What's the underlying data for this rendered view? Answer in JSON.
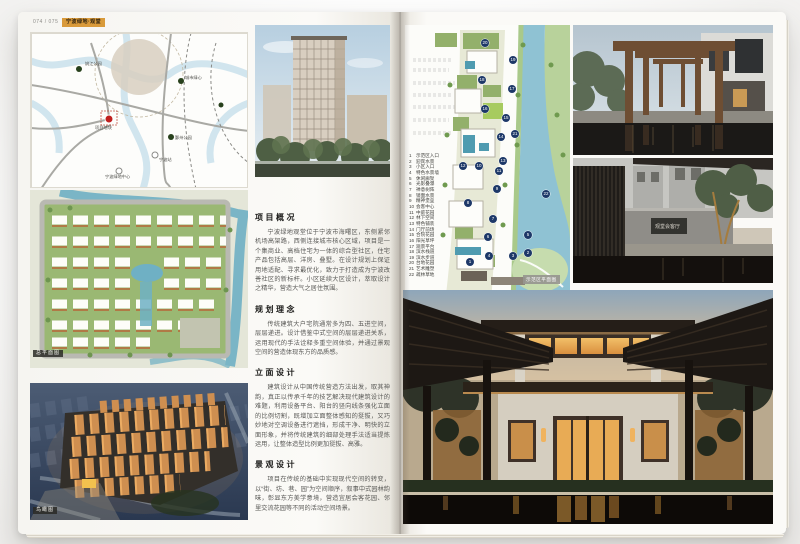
{
  "header": {
    "page_label": "074 / 075",
    "badge": "宁波绿地·观堂"
  },
  "left_page": {
    "map": {
      "caption": "区位图",
      "labels": [
        {
          "text": "姚江公园",
          "x": 54,
          "y": 28
        },
        {
          "text": "城市绿心",
          "x": 154,
          "y": 42
        },
        {
          "text": "鄞州公园",
          "x": 144,
          "y": 102
        },
        {
          "text": "项目地块",
          "x": 64,
          "y": 92
        },
        {
          "text": "宁波站",
          "x": 128,
          "y": 124
        },
        {
          "text": "宁波绿地中心",
          "x": 74,
          "y": 141
        }
      ]
    },
    "site_plan": {
      "caption": "总平面图"
    },
    "aerial": {
      "caption": "鸟瞰图"
    },
    "sections": [
      {
        "title": "项目概况",
        "body": "宁波绿地观堂位于宁波市海曙区，东侧紧邻机场高架路，西侧连接城市核心区域，项目是一个集商业、高档住宅为一体的综合型社区，住宅产品包括高层、洋房、叠墅。在设计规划上保证用地适配、寻求最优化，致力于打造成为宁波改善社区的新标杆。小区延续大区设计，萃取设计之精华，营造大气之居住氛围。"
      },
      {
        "title": "规划理念",
        "body": "传统建筑大户宅院通常多为四、五进空间，层层递进。设计借鉴中式空间的层层递进关系，运用现代的手法诠释多重空间体验，并通过景观空间的营造体现东方的品质感。"
      },
      {
        "title": "立面设计",
        "body": "建筑设计从中国传统营造方法出发，取其神韵，真正以传承千年的技艺解决现代建筑设计的难题，利用设备平台、阳台的竖向线条强化立面的比例切割，既增加立面整体感知的挺拔，又巧妙地对空调设备进行遮挡，形成干净、明快的立面形象，并将传统建筑的细部处理手法适当提炼运用，让整体造型比例更加挺拔、高雅。"
      },
      {
        "title": "景观设计",
        "body": "项目在传统的基础中实现现代空间的转变，以“街、坊、巷、园”为空间顺序，叙事中式园林韵味，彰显东方美学意境，营造宜居会客花园、邻里交流花园等不同的活动空间场景。"
      }
    ]
  },
  "right_page": {
    "plan": {
      "caption": "示范区平面图",
      "legend": [
        {
          "n": 1,
          "label": "示范区入口"
        },
        {
          "n": 2,
          "label": "迎宾水景"
        },
        {
          "n": 3,
          "label": "小区入口"
        },
        {
          "n": 4,
          "label": "特色水景墙"
        },
        {
          "n": 5,
          "label": "休闲廊架"
        },
        {
          "n": 6,
          "label": "光影叠瀑"
        },
        {
          "n": 7,
          "label": "禅意树阵"
        },
        {
          "n": 8,
          "label": "镜面水景"
        },
        {
          "n": 9,
          "label": "精神堡垒"
        },
        {
          "n": 10,
          "label": "会客中心"
        },
        {
          "n": 11,
          "label": "中庭花园"
        },
        {
          "n": 12,
          "label": "林下空间"
        },
        {
          "n": 13,
          "label": "特色铺装"
        },
        {
          "n": 14,
          "label": "门厅前场"
        },
        {
          "n": 15,
          "label": "合院花园"
        },
        {
          "n": 16,
          "label": "阳光草坪"
        },
        {
          "n": 17,
          "label": "观景平台"
        },
        {
          "n": 18,
          "label": "滨水栈道"
        },
        {
          "n": 19,
          "label": "滨水步道"
        },
        {
          "n": 20,
          "label": "台地花园"
        },
        {
          "n": 21,
          "label": "艺术雕塑"
        },
        {
          "n": 22,
          "label": "疏林草地"
        }
      ],
      "markers": [
        {
          "n": 20,
          "x": 80,
          "y": 18
        },
        {
          "n": 19,
          "x": 108,
          "y": 35
        },
        {
          "n": 18,
          "x": 77,
          "y": 55
        },
        {
          "n": 17,
          "x": 107,
          "y": 64
        },
        {
          "n": 16,
          "x": 80,
          "y": 84
        },
        {
          "n": 15,
          "x": 101,
          "y": 93
        },
        {
          "n": 21,
          "x": 110,
          "y": 109
        },
        {
          "n": 14,
          "x": 96,
          "y": 112
        },
        {
          "n": 13,
          "x": 98,
          "y": 136
        },
        {
          "n": 12,
          "x": 58,
          "y": 141
        },
        {
          "n": 10,
          "x": 74,
          "y": 141
        },
        {
          "n": 11,
          "x": 94,
          "y": 146
        },
        {
          "n": 9,
          "x": 92,
          "y": 164
        },
        {
          "n": 8,
          "x": 63,
          "y": 178
        },
        {
          "n": 22,
          "x": 141,
          "y": 169
        },
        {
          "n": 7,
          "x": 88,
          "y": 194
        },
        {
          "n": 6,
          "x": 83,
          "y": 212
        },
        {
          "n": 5,
          "x": 123,
          "y": 210
        },
        {
          "n": 4,
          "x": 84,
          "y": 231
        },
        {
          "n": 3,
          "x": 108,
          "y": 231
        },
        {
          "n": 2,
          "x": 123,
          "y": 228
        },
        {
          "n": 1,
          "x": 65,
          "y": 237
        }
      ]
    },
    "photos": {
      "courtyard_plaque": "观堂会客厅"
    }
  },
  "colors": {
    "badge": "#d99a3a",
    "marker_navy": "#1d3868",
    "river": "#8fc2d3",
    "site_green": "#9ab873",
    "dusk_orange": "#cf8f50",
    "pool_dark": "#100c09"
  }
}
